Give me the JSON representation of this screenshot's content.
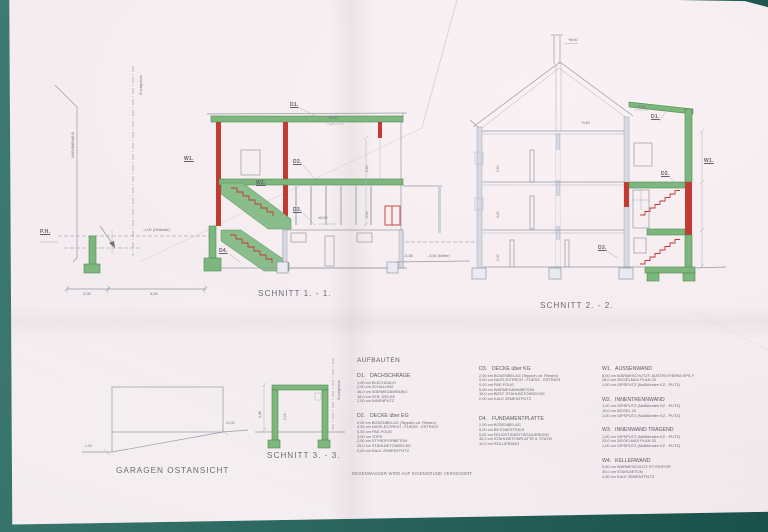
{
  "colors": {
    "background_teal": "#2f6b63",
    "paper": "#f4ecef",
    "green": "#7db77e",
    "red": "#c23a31",
    "line_gray": "#9399a6",
    "text": "#6a6a73"
  },
  "titles": {
    "schnitt1": "SCHNITT 1. - 1.",
    "schnitt2": "SCHNITT 2. - 2.",
    "schnitt3": "SCHNITT 3. - 3.",
    "garage": "GARAGEN OSTANSICHT",
    "aufbauten": "AUFBAUTEN",
    "footer": "REGENWASSER WIRD AUF EIGENGRUND VERSICKERT"
  },
  "site": {
    "nachbarhaus": "NACHBARHAUS",
    "grundgrenze1": "Grundgrenze",
    "grundgrenze2": "Grundgrenze",
    "ph": "P.H.",
    "gelaende": "-1,00 (Gelände)",
    "keller": "-3,30 (Keller)",
    "minus038": "-0,38"
  },
  "sec1": {
    "d1": "D1.",
    "w1": "W1.",
    "w2": "W2.",
    "d2": "D2.",
    "d3": "D3.",
    "d4": "D4.",
    "elev_top": "+5,80",
    "elev_zero": "±0,00",
    "dim1": "2,00",
    "dim2": "4,00",
    "vdim1": "2,60",
    "vdim2": "2,60"
  },
  "sec2": {
    "d1": "D1.",
    "w1": "W1.",
    "d2": "D2.",
    "d3": "D3.",
    "ridge": "+8,60",
    "eave_l": "+5,80",
    "eave_r": "+5,80",
    "vdim1": "2,60",
    "vdim2": "2,60",
    "vdim3": "2,30"
  },
  "garage": {
    "zero": "±0,00",
    "minus": "-1,00"
  },
  "sec3": {
    "dim_outer": "2,46",
    "dim_inner": "2,26"
  },
  "aufbauten": {
    "col1": [
      {
        "code": "D1.",
        "name": "DACHSCHRÄGE",
        "lines": [
          "1,00 cm BLECHDACH",
          "2,40 cm SCHALUNG",
          "16,0 cm WÄRMEDÄMMUNG",
          "18,0 cm STB. DECKE",
          "2,00 cm INNENPUTZ"
        ]
      },
      {
        "code": "D2.",
        "name": "DECKE über EG",
        "lines": [
          "2,00 cm BODENBELAG (Teppich od. Fliesen)",
          "4,30 cm NASS-ESTRICH - FLIESS - ESTRICH",
          "0,02 cm PAE-FOLIE",
          "3,00 cm TDPS",
          "2,00 cm STYROPORBETON",
          "25,0 cm STAHLBETONDECKE",
          "2,00 cm KALK ZEMENTPUTZ"
        ]
      }
    ],
    "col2": [
      {
        "code": "D3.",
        "name": "DECKE über KG",
        "lines": [
          "2,00 cm BODENBELAG (Teppich od. Fliesen)",
          "5,00 cm NASS-ESTRICH - FLIESS - ESTRICH",
          "0,02 cm PAE-FOLIE",
          "5,00 cm WÄRMEDÄMMBETON",
          "16,0 cm BEST. STAHLBETONDECKE",
          "2,00 cm KALK ZEMENTPUTZ"
        ]
      },
      {
        "code": "D4.",
        "name": "FUNDAMENTPLATTE",
        "lines": [
          "2,00 cm BODENBELAG",
          "5,00 cm BETONESTRICH",
          "0,02 cm FEUCHTIGKEITSISOLIERUNG",
          "30,0 cm STAHLBETONPLATTE lt. STATIK",
          "10,0 cm ROLLIERUNG"
        ]
      }
    ],
    "col3": [
      {
        "code": "W1.",
        "name": "AUSSENWAND",
        "lines": [
          "8,00 cm WÄRMESCHUTZF. AUSTROTHERM EPS-F",
          "25,0 cm ZIEGELMAX PLAN 25",
          "1,00 cm GIPSPUTZ (Naßbürsten KZ - PUTZ)"
        ]
      },
      {
        "code": "W2.",
        "name": "INNENTRENNWAND",
        "lines": [
          "1,00 cm GIPSPUTZ (Naßbürsten KZ - PUTZ)",
          "10,0 cm ZIEGEL 10",
          "1,00 cm GIPSPUTZ (Naßbürsten KZ - PUTZ)"
        ]
      },
      {
        "code": "W3.",
        "name": "INNENWAND TRAGEND",
        "lines": [
          "1,00 cm GIPSPUTZ (Naßbürsten KZ - PUTZ)",
          "25,0 cm ZIEGELMAX PLAN 25",
          "1,00 cm GIPSPUTZ (Naßbürsten KZ - PUTZ)"
        ]
      },
      {
        "code": "W4.",
        "name": "KELLERWAND",
        "lines": [
          "5,00 cm WÄRMESCHUTZ STYROPOR",
          "30,0 cm STAHLBETON",
          "1,00 cm KALK ZEMENTPUTZ"
        ]
      }
    ]
  }
}
